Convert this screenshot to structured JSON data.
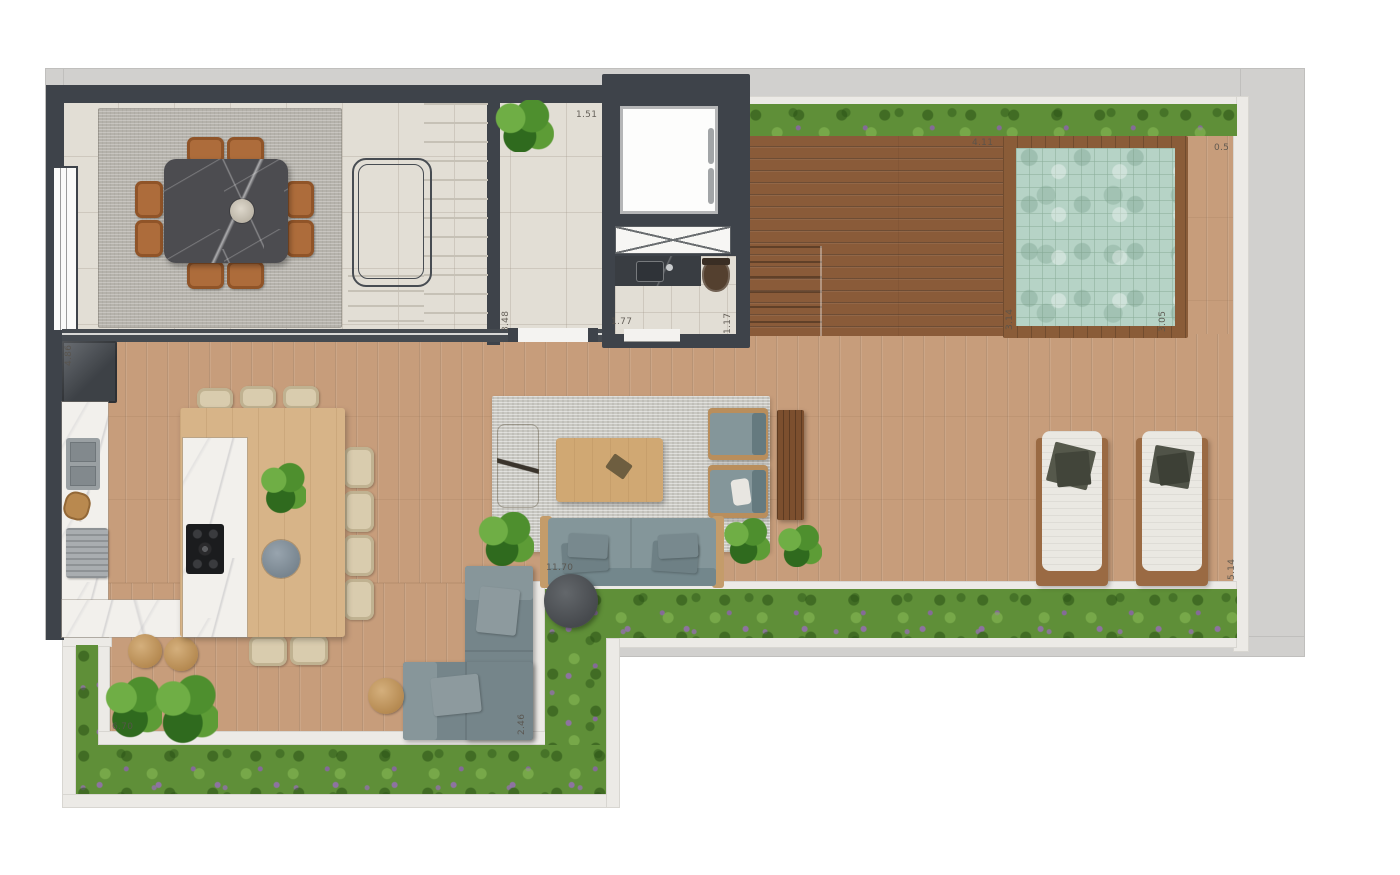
{
  "dimensions": {
    "hall_width": "1.51",
    "hall_depth": "3.48",
    "bath_width": "1.77",
    "bath_depth": "1.17",
    "deck_width": "4.11",
    "pool_offset": "0.5",
    "pool_length": "3.14",
    "pool_width": "3.05",
    "kitchen_depth": "4.86",
    "terrace_length": "11.70",
    "garden_length": "6.70",
    "sofa_depth": "2.46",
    "deck_depth": "5.14"
  },
  "palette": {
    "wall_dark_gray": "#3e434a",
    "slab_gray": "#d1d0ce",
    "tile_floor_beige": "#e2ded5",
    "wood_floor_light": "#c79d7b",
    "deck_wood_dark": "#8a5b39",
    "pool_water_green": "#b6d3c6",
    "garden_green": "#5f8f38",
    "garden_flower_purple": "#9678b8",
    "marble_white": "#f2f0ec",
    "marble_black": "#4c4c50",
    "dining_chair_tan": "#ad6c3b",
    "outdoor_sofa_gray": "#84969a"
  }
}
